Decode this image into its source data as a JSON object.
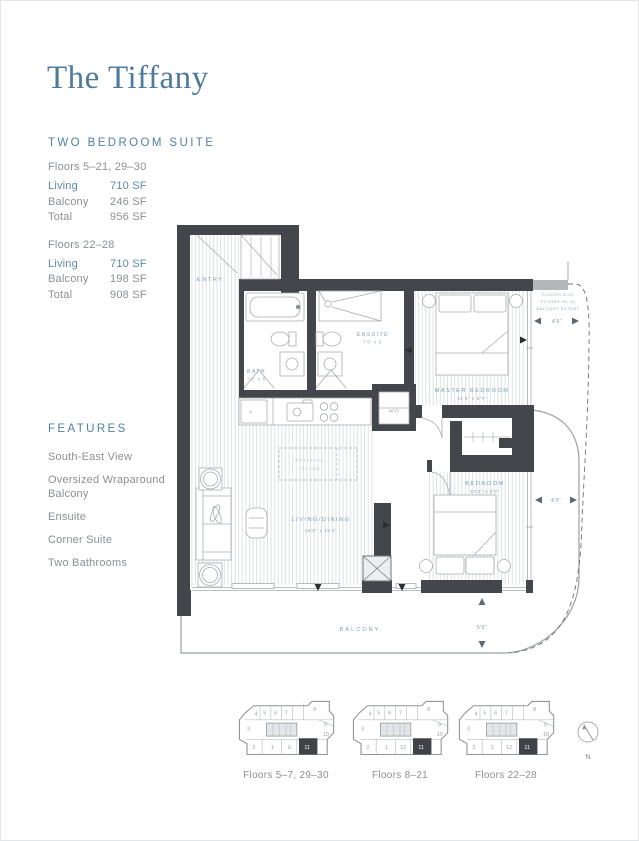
{
  "colors": {
    "title_blue": "#4e7a9c",
    "heading_blue": "#4f81a3",
    "accent_value_blue": "#5d89a6",
    "body_gray": "#8b8f93",
    "wall_dark": "#43474b",
    "plan_label_blue": "#7b9cb4"
  },
  "header": {
    "title": "The Tiffany",
    "suite_type": "TWO BEDROOM SUITE"
  },
  "stats_blocks": [
    {
      "floors": "Floors 5–21, 29–30",
      "rows": [
        {
          "label": "Living",
          "value": "710 SF"
        },
        {
          "label": "Balcony",
          "value": "246 SF"
        },
        {
          "label": "Total",
          "value": "956 SF"
        }
      ]
    },
    {
      "floors": "Floors 22–28",
      "rows": [
        {
          "label": "Living",
          "value": "710 SF"
        },
        {
          "label": "Balcony",
          "value": "198 SF"
        },
        {
          "label": "Total",
          "value": "908 SF"
        }
      ]
    }
  ],
  "features": {
    "heading": "FEATURES",
    "items": [
      "South-East View",
      "Oversized Wraparound Balcony",
      "Ensuite",
      "Corner Suite",
      "Two Bathrooms"
    ]
  },
  "floorplan": {
    "entry": "ENTRY",
    "bath": "BATH",
    "bath_dims": "7'6\" x 5'",
    "ensuite": "ENSUITE",
    "ensuite_dims": "7'6\" x 5'",
    "master": "MASTER BEDROOM",
    "master_dims": "11'5\" x 9'7\"",
    "bedroom": "BEDROOM",
    "bedroom_dims": "10'5\" x 9'2\"",
    "living": "LIVING/DINING",
    "living_dims": "15'8\" x 15'3\"",
    "wd": "W/D",
    "fridge": "F",
    "island_line1": "OPTIONAL",
    "island_line2": "ISLAND",
    "balcony": "BALCONY",
    "note_line1": "FLOORS 5–21",
    "note_line2": "FLOORS 29–30",
    "note_line3": "BALCONY EXTENT",
    "dim_east_upper": "4'6\"",
    "dim_east_lower": "4'0\"",
    "dim_south": "5'0\""
  },
  "keyplans": [
    {
      "label": "Floors 5–7, 29–30",
      "units": [
        "4",
        "5",
        "6",
        "7",
        "8",
        "9",
        "10",
        "3",
        "2",
        "1",
        "E",
        "11"
      ]
    },
    {
      "label": "Floors 8–21",
      "units": [
        "4",
        "5",
        "6",
        "7",
        "8",
        "9",
        "10",
        "3",
        "2",
        "1",
        "12",
        "11"
      ]
    },
    {
      "label": "Floors 22–28",
      "units": [
        "4",
        "5",
        "6",
        "7",
        "8",
        "9",
        "10",
        "3",
        "2",
        "1",
        "12",
        "11"
      ]
    }
  ],
  "compass": {
    "n": "N"
  }
}
